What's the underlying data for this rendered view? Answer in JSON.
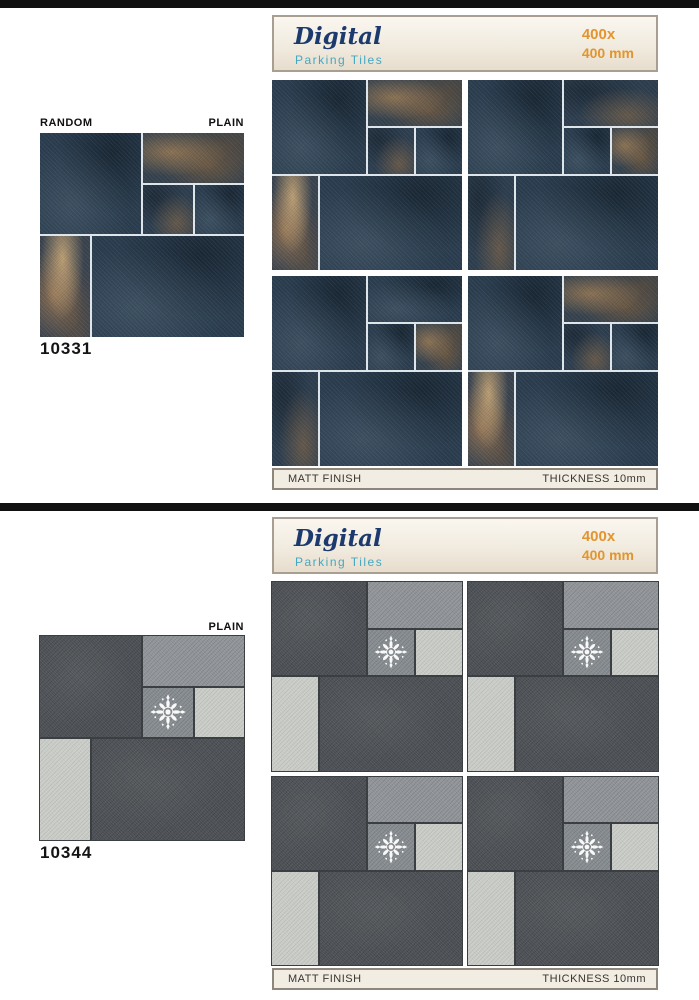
{
  "page": {
    "background": "#ffffff",
    "divider_color": "#101010"
  },
  "colors": {
    "brand_text": "#1d3a6e",
    "subtitle_text": "#44a8c2",
    "size_text": "#e2952e",
    "header_border": "#a89e91",
    "footer_bg": "#f2ede3",
    "tile_dark_blue": "#2b3e50",
    "tile_rust": "#8a6c4c",
    "tile_gray_dark": "#4b4f53",
    "tile_gray_medium": "#8f9397",
    "tile_gray_light": "#c7cac5",
    "grout_light": "#dde5ea",
    "grout_dark": "#3b3f42"
  },
  "sections": [
    {
      "name": "blue-rust-tile-series",
      "header": {
        "brand": "Digital",
        "subtitle": "Parking Tiles",
        "size_top": "400x",
        "size_bottom": "400 mm"
      },
      "labels": {
        "left": "RANDOM",
        "right": "PLAIN"
      },
      "product_code": "10331",
      "footer": {
        "finish": "MATT FINISH",
        "thickness": "THICKNESS 10mm"
      },
      "motif": "none",
      "preview_tiles": [
        "dark",
        "rust",
        "darkrust",
        "dark",
        "rustheavy",
        "dark"
      ],
      "quadrants": [
        [
          "dark",
          "rust",
          "darkrust",
          "dark",
          "rustheavy",
          "dark"
        ],
        [
          "dark",
          "darkrust",
          "dark",
          "rust",
          "darkrust",
          "dark"
        ],
        [
          "dark",
          "dark",
          "dark",
          "rust",
          "darkrust",
          "dark"
        ],
        [
          "dark",
          "rust",
          "darkrust",
          "dark",
          "rustheavy",
          "dark"
        ]
      ]
    },
    {
      "name": "gray-tile-series",
      "header": {
        "brand": "Digital",
        "subtitle": "Parking Tiles",
        "size_top": "400x",
        "size_bottom": "400 mm"
      },
      "labels": {
        "right": "PLAIN"
      },
      "product_code": "10344",
      "footer": {
        "finish": "MATT FINISH",
        "thickness": "THICKNESS 10mm"
      },
      "motif": "damask-ornament",
      "preview_tiles": [
        "gdark",
        "gmed",
        "gmotif",
        "glight",
        "glight",
        "gdark"
      ],
      "quadrants": [
        [
          "gdark",
          "gmed",
          "gmotif",
          "glight",
          "glight",
          "gdark"
        ],
        [
          "gdark",
          "gmed",
          "gmotif",
          "glight",
          "glight",
          "gdark"
        ],
        [
          "gdark",
          "gmed",
          "gmotif",
          "glight",
          "glight",
          "gdark"
        ],
        [
          "gdark",
          "gmed",
          "gmotif",
          "glight",
          "glight",
          "gdark"
        ]
      ]
    }
  ]
}
